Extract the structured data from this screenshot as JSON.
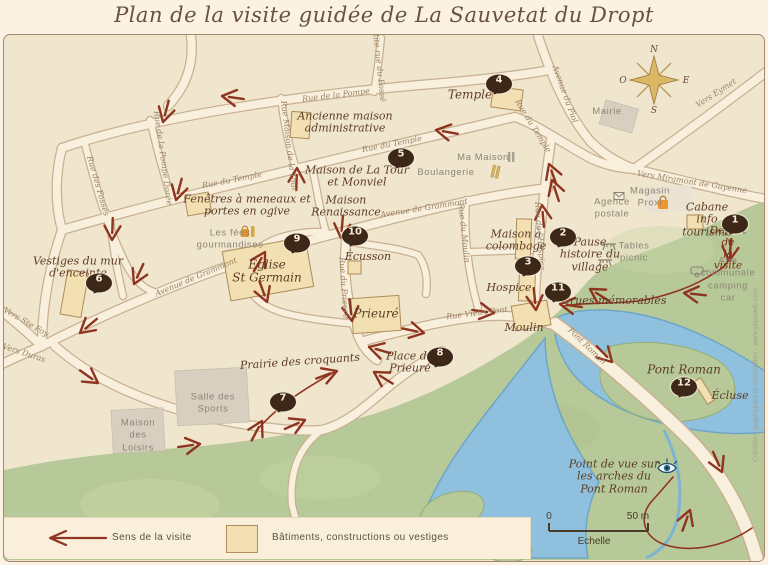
{
  "title": "Plan de la visite guidée de La Sauvetat du Dropt",
  "colors": {
    "map_bg": "#f0e5cd",
    "street": "#f8f0dd",
    "building": "#f2e0b2",
    "water": "#8fc0dd",
    "green": "#b7c998",
    "route": "#8e3420",
    "marker": "#3c2718"
  },
  "compass": {
    "north": "N",
    "south": "S",
    "east": "E",
    "west": "O"
  },
  "markers": [
    {
      "n": "1",
      "x": 735,
      "y": 224
    },
    {
      "n": "2",
      "x": 563,
      "y": 237
    },
    {
      "n": "3",
      "x": 528,
      "y": 266
    },
    {
      "n": "4",
      "x": 499,
      "y": 84
    },
    {
      "n": "5",
      "x": 401,
      "y": 158
    },
    {
      "n": "6",
      "x": 99,
      "y": 283
    },
    {
      "n": "7",
      "x": 283,
      "y": 402
    },
    {
      "n": "8",
      "x": 440,
      "y": 357
    },
    {
      "n": "9",
      "x": 297,
      "y": 243
    },
    {
      "n": "10",
      "x": 355,
      "y": 236
    },
    {
      "n": "11",
      "x": 558,
      "y": 292
    },
    {
      "n": "12",
      "x": 684,
      "y": 387
    }
  ],
  "poi_labels": [
    {
      "text": "Temple",
      "x": 470,
      "y": 95,
      "size": 12
    },
    {
      "text": "Ancienne maison\nadministrative",
      "x": 345,
      "y": 123
    },
    {
      "text": "Maison de La Tour\net Monviel",
      "x": 357,
      "y": 177
    },
    {
      "text": "Maison\nRenaissance",
      "x": 346,
      "y": 207
    },
    {
      "text": "Fenêtres à meneaux et\nportes en ogive",
      "x": 247,
      "y": 206
    },
    {
      "text": "Vestiges du mur\nd'enceinte",
      "x": 78,
      "y": 268
    },
    {
      "text": "Église\nSt Germain",
      "x": 267,
      "y": 272,
      "size": 12
    },
    {
      "text": "Écusson",
      "x": 368,
      "y": 257
    },
    {
      "text": "Prieuré",
      "x": 376,
      "y": 314,
      "size": 12
    },
    {
      "text": "Maison à\ncolombage",
      "x": 516,
      "y": 241
    },
    {
      "text": "Hospice",
      "x": 509,
      "y": 288
    },
    {
      "text": "Moulin",
      "x": 524,
      "y": 328
    },
    {
      "text": "Place du\nPrieuré",
      "x": 410,
      "y": 363
    },
    {
      "text": "Prairie des croquants",
      "x": 300,
      "y": 362,
      "rot": -4
    },
    {
      "text": "Pause\nhistoire du\nvillage",
      "x": 590,
      "y": 255
    },
    {
      "text": "Cabane\ninfo\ntourisme",
      "x": 707,
      "y": 220
    },
    {
      "text": "Départ de\nla visite",
      "x": 728,
      "y": 249,
      "size": 10.5,
      "color": "#7c2c18"
    },
    {
      "text": "Crues mémorables",
      "x": 614,
      "y": 301
    },
    {
      "text": "Pont Roman",
      "x": 684,
      "y": 370,
      "size": 12
    },
    {
      "text": "Écluse",
      "x": 730,
      "y": 396
    },
    {
      "text": "Point de vue sur\nles arches du\nPont Roman",
      "x": 614,
      "y": 477
    }
  ],
  "info_labels": [
    {
      "text": "Mairie",
      "x": 607,
      "y": 112
    },
    {
      "text": "Ma Maison",
      "x": 483,
      "y": 158
    },
    {
      "text": "Boulangerie",
      "x": 446,
      "y": 173
    },
    {
      "text": "Magasin\nProxi",
      "x": 650,
      "y": 198
    },
    {
      "text": "Agence\npostale",
      "x": 612,
      "y": 209
    },
    {
      "text": "Tables\npicnic",
      "x": 634,
      "y": 253
    },
    {
      "text": "Aire\ncommunale\ncamping car",
      "x": 728,
      "y": 280
    },
    {
      "text": "Les fées\ngourmandises",
      "x": 230,
      "y": 240
    },
    {
      "text": "Salle des\nSports",
      "x": 213,
      "y": 404
    },
    {
      "text": "Maison\ndes\nLoisirs",
      "x": 138,
      "y": 436
    }
  ],
  "street_labels": [
    {
      "text": "Rue de la Pompe",
      "x": 336,
      "y": 95,
      "rot": -7
    },
    {
      "text": "Petite rue du Fossé",
      "x": 379,
      "y": 63,
      "rot": 84
    },
    {
      "text": "Rue du Temple",
      "x": 232,
      "y": 180,
      "rot": -11
    },
    {
      "text": "Rue du Temple",
      "x": 392,
      "y": 144,
      "rot": -11
    },
    {
      "text": "Rue du Temple",
      "x": 533,
      "y": 126,
      "rot": 58
    },
    {
      "text": "Rue des Fossés",
      "x": 98,
      "y": 186,
      "rot": 74
    },
    {
      "text": "Rue de la Pompe Dorée",
      "x": 163,
      "y": 158,
      "rot": 82
    },
    {
      "text": "Rue Maison de la Tour",
      "x": 289,
      "y": 146,
      "rot": 83
    },
    {
      "text": "Avenue de Grammont",
      "x": 196,
      "y": 277,
      "rot": -23
    },
    {
      "text": "Avenue de Grammont",
      "x": 424,
      "y": 208,
      "rot": -9
    },
    {
      "text": "Rue du Prieuré",
      "x": 344,
      "y": 288,
      "rot": 86
    },
    {
      "text": "Rue du Moulin",
      "x": 464,
      "y": 233,
      "rot": 84
    },
    {
      "text": "Rue de l'Hospice",
      "x": 540,
      "y": 236,
      "rot": 86
    },
    {
      "text": "Rue Vieux Pont",
      "x": 477,
      "y": 313,
      "rot": -7
    },
    {
      "text": "Avenue du Piol",
      "x": 565,
      "y": 94,
      "rot": 70
    },
    {
      "text": "Vers Eymet",
      "x": 716,
      "y": 93,
      "rot": -33
    },
    {
      "text": "Vers Miramont de Guyenne",
      "x": 692,
      "y": 182,
      "rot": 9
    },
    {
      "text": "Pont Roman",
      "x": 587,
      "y": 346,
      "rot": 44
    },
    {
      "text": "Vers Ste Foy",
      "x": 26,
      "y": 322,
      "rot": 30
    },
    {
      "text": "Vers Duras",
      "x": 24,
      "y": 353,
      "rot": 18
    }
  ],
  "legend": {
    "route_label": "Sens de la visite",
    "building_label": "Bâtiments, constructions ou vestiges"
  },
  "scale": {
    "start": "0",
    "end": "50 m",
    "label": "Echelle"
  },
  "credits": "Créations graphiques et conception - www.pixaweb.com",
  "icons": [
    "compass-rose",
    "shopping-bag",
    "gift-bag",
    "post-office",
    "picnic-table",
    "camping-car",
    "eye-viewpoint",
    "bread",
    "house",
    "route-arrow"
  ]
}
